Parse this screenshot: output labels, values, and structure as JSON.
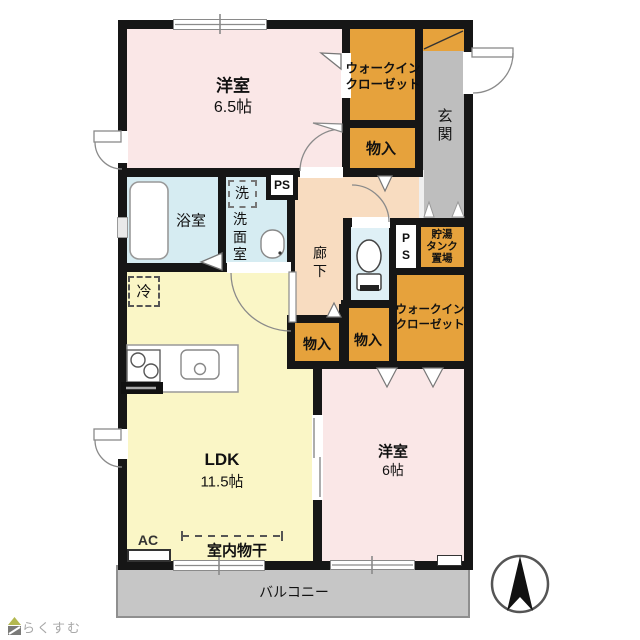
{
  "floorplan": {
    "rooms": {
      "bedroom_main": {
        "name": "洋室",
        "size": "6.5帖"
      },
      "wic_top": {
        "line1": "ウォークイン",
        "line2": "クローゼット"
      },
      "storage_top": {
        "label": "物入"
      },
      "entrance": {
        "label": "玄関"
      },
      "bathroom": {
        "label": "浴室"
      },
      "washroom": {
        "label": "洗面室",
        "washer": "洗"
      },
      "corridor": {
        "label": "廊下"
      },
      "ps_upper": {
        "label": "PS"
      },
      "ps_mid": {
        "line1": "P",
        "line2": "S"
      },
      "tank": {
        "line1": "貯湯",
        "line2": "タンク",
        "line3": "置場"
      },
      "wic_right": {
        "line1": "ウォークイン",
        "line2": "クローゼット"
      },
      "storage_left": {
        "label": "物入"
      },
      "storage_right": {
        "label": "物入"
      },
      "toilet": {
        "label": ""
      },
      "ldk": {
        "name": "LDK",
        "size": "11.5帖"
      },
      "bedroom_second": {
        "name": "洋室",
        "size": "6帖"
      },
      "fridge": {
        "label": "冷"
      },
      "ac": {
        "label": "AC"
      },
      "indoor_drying": {
        "label": "室内物干"
      },
      "balcony": {
        "label": "バルコニー"
      }
    },
    "logo": {
      "text": "らくすむ"
    },
    "colors": {
      "wall": "#161616",
      "bedroom_pink": "#FAE7E7",
      "closet_orange": "#E6A23C",
      "entrance_gray": "#BEBEBE",
      "bath_blue": "#D6ECF2",
      "toilet_blue": "#DFF0F6",
      "corridor_peach": "#F8DCC0",
      "ldk_yellow": "#FAF6C6",
      "balcony_gray": "#C6C6C6",
      "logo_gray": "#A8A8A8",
      "logo_roof_green": "#B3B84F"
    }
  }
}
